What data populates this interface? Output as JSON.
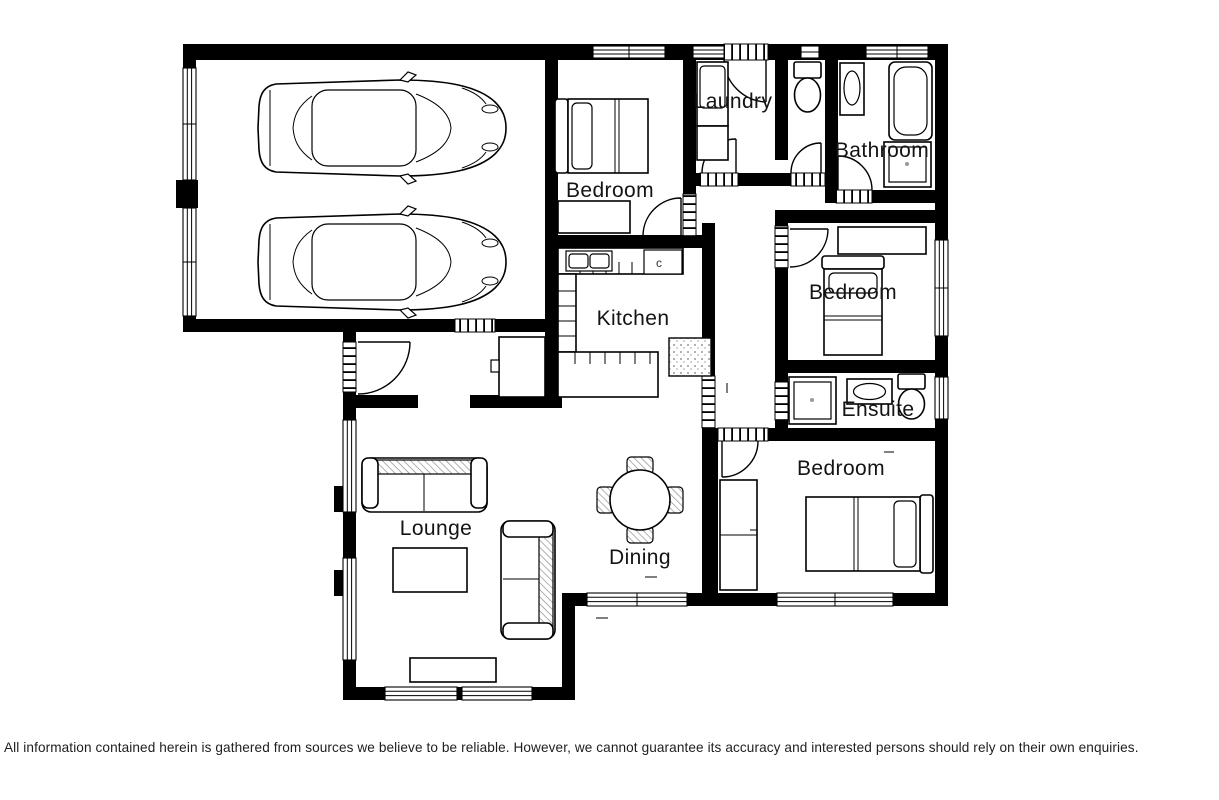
{
  "colors": {
    "wall": "#000000",
    "background": "#ffffff",
    "label": "#141414"
  },
  "rooms": {
    "bedroom_top": "Bedroom",
    "laundry": "Laundry",
    "bathroom": "Bathroom",
    "kitchen": "Kitchen",
    "bedroom_middle": "Bedroom",
    "ensuite": "Ensuite",
    "bedroom_bottom": "Bedroom",
    "lounge": "Lounge",
    "dining": "Dining",
    "stove_mark": "c"
  },
  "disclaimer": "All information contained herein is gathered from sources we believe to be reliable. However, we cannot guarantee its accuracy and interested persons should rely on their own enquiries."
}
